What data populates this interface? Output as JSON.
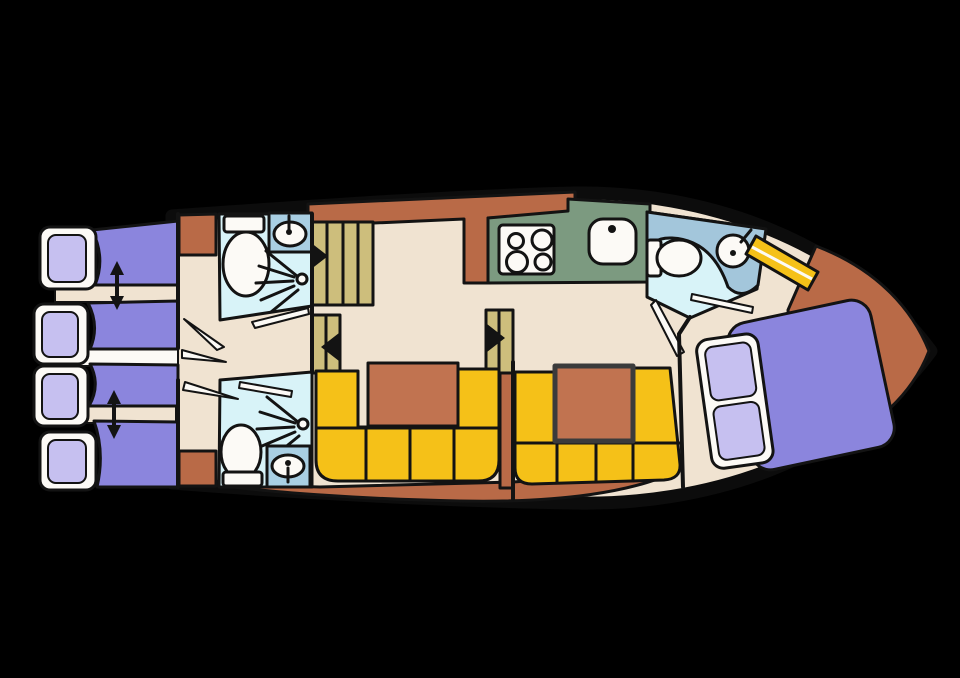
{
  "scene": {
    "kind": "boat-deck-floor-plan",
    "background": "#000000"
  },
  "palette": {
    "ink": "#131313",
    "floor": "#F0E3D1",
    "deck": "#B96A47",
    "table": "#C17350",
    "bed": "#8B85DD",
    "pillow": "#C6C0F0",
    "white": "#FCFAF6",
    "sofa": "#F5C118",
    "bath": "#D8F3F8",
    "sink_box": "#A9CFE3",
    "counter": "#A3C6DB",
    "kitchen": "#7C9A80",
    "steps": "#CDBE7C"
  },
  "inventory": {
    "aft_cabin": {
      "single_berths": 4,
      "pillows": 4,
      "slide_arrows": 2
    },
    "aft_bathroom_top": {
      "fixtures": [
        "toilet",
        "washbasin",
        "shower"
      ]
    },
    "aft_bathroom_bottom": {
      "fixtures": [
        "toilet",
        "washbasin",
        "shower"
      ]
    },
    "galley": {
      "hob_burners": 4,
      "sinks": 1
    },
    "saloon": {
      "dinette_sofas": 2,
      "tables": 2
    },
    "bow_bathroom": {
      "fixtures": [
        "toilet",
        "washbasin"
      ]
    },
    "bow_cabin": {
      "double_berths": 1,
      "pillows": 2
    },
    "companionways": {
      "main_stair_treads": 4,
      "mid_step_units": 2
    }
  }
}
